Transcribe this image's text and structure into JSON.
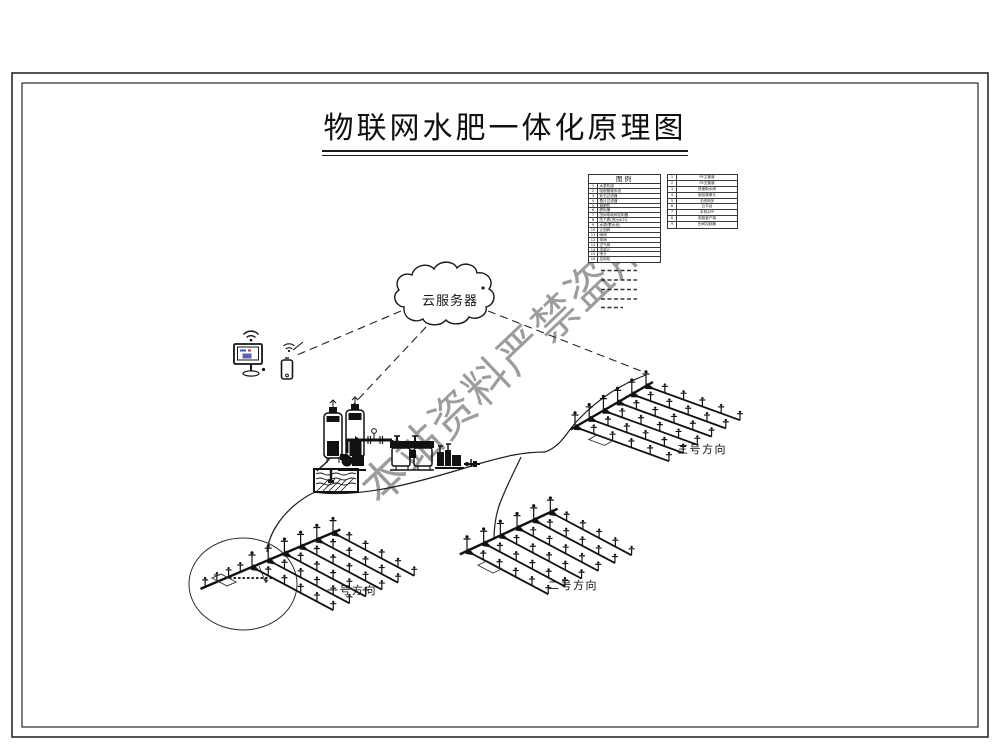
{
  "title": "物联网水肥一体化原理图",
  "watermark": "本站资料严禁盗用",
  "cloud": {
    "label": "云服务器"
  },
  "legend": {
    "header": "图例",
    "left_rows": [
      [
        "1",
        "水泵机组"
      ],
      [
        "2",
        "吸程管路系统"
      ],
      [
        "3",
        "砂石过滤器"
      ],
      [
        "4",
        "叠片过滤器"
      ],
      [
        "5",
        "施肥机"
      ],
      [
        "6",
        "肥料桶"
      ],
      [
        "7",
        "田间电磁阀控制器"
      ],
      [
        "8",
        "压力表(进出水口)"
      ],
      [
        "9",
        "水源(蓄水池)"
      ],
      [
        "10",
        "止回阀"
      ],
      [
        "11",
        "闸阀"
      ],
      [
        "12",
        "球阀"
      ],
      [
        "13",
        "空气阀"
      ],
      [
        "14",
        "流量计"
      ],
      [
        "15",
        "喷头"
      ],
      [
        "16",
        "控制柜"
      ]
    ],
    "right_rows": [
      [
        "1",
        "PE主管道"
      ],
      [
        "2",
        "PE支管道"
      ],
      [
        "3",
        "快速取水阀"
      ],
      [
        "4",
        "倒挂微喷头"
      ],
      [
        "5",
        "无线网关"
      ],
      [
        "6",
        "云平台"
      ],
      [
        "7",
        "手机APP"
      ],
      [
        "8",
        "电脑客户端"
      ],
      [
        "9",
        "田间控制器"
      ]
    ]
  },
  "fields": {
    "f1": "一号方向",
    "f2": "二号方向",
    "f3": "三号方向"
  }
}
